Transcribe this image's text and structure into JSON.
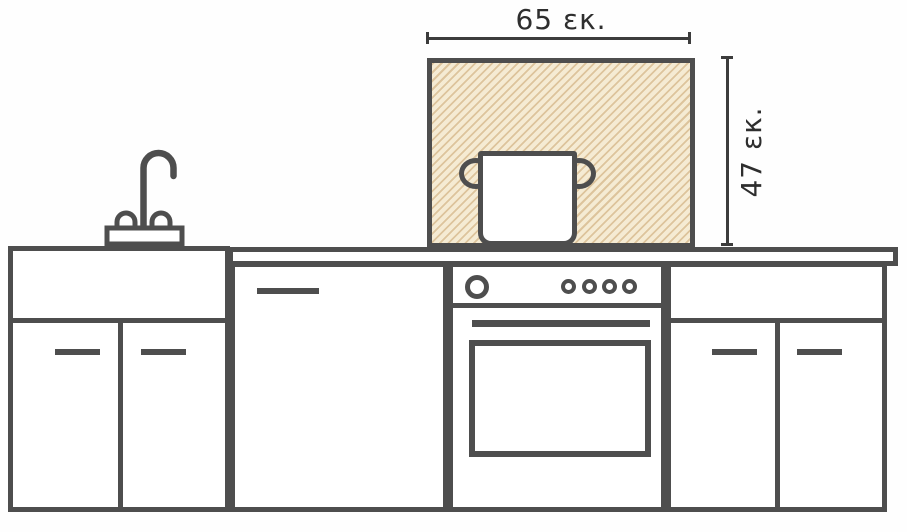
{
  "labels": {
    "width": "65 εκ.",
    "height": "47 εκ."
  },
  "colors": {
    "outline": "#4e4e4e",
    "dimension": "#3c3c3c",
    "text": "#2e2e2e",
    "hatch_bg": "#f5ebd3",
    "hatch_line": "#ddc49c",
    "surface": "#ffffff",
    "page_bg": "#fefefe"
  }
}
